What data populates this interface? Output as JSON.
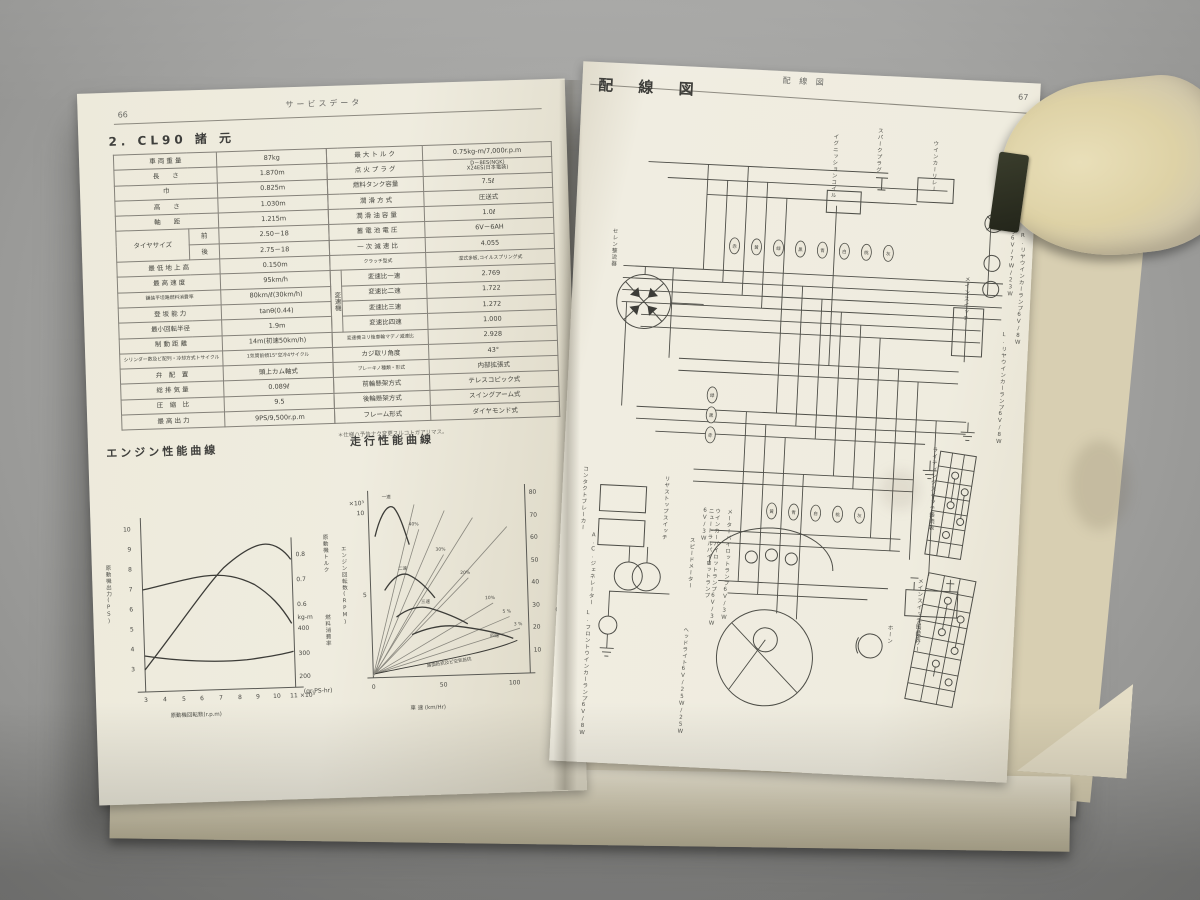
{
  "photo": {
    "background_color": "#a2a2a0",
    "page_color": "#efecdf",
    "object_description": "beige-block-on-page"
  },
  "left_page": {
    "page_number": "66",
    "header": "サービスデータ",
    "section_title": "2. CL90 諸 元",
    "tire": {
      "label": "タイヤサイズ",
      "front_key": "前",
      "front": "2.50－18",
      "rear_key": "後",
      "rear": "2.75－18"
    },
    "gear_group": "変速機",
    "spec_left": [
      {
        "label": "車 両 重 量",
        "value": "87kg"
      },
      {
        "label": "長　　さ",
        "value": "1.870m"
      },
      {
        "label": "巾",
        "value": "0.825m"
      },
      {
        "label": "高　　さ",
        "value": "1.030m"
      },
      {
        "label": "軸　　距",
        "value": "1.215m"
      },
      {
        "label": "最 低 地 上 高",
        "value": "0.150m"
      },
      {
        "label": "最 高 速 度",
        "value": "95km/h"
      },
      {
        "label": "舗装平坦路燃料消費率",
        "value": "80km/ℓ(30km/h)"
      },
      {
        "label": "登 坂 能 力",
        "value": "tanθ(0.44)"
      },
      {
        "label": "最小回転半径",
        "value": "1.9m"
      },
      {
        "label": "制 動 距 離",
        "value": "14m(初速50km/h)"
      },
      {
        "label": "シリンダー数及ビ配列・冷却方式トサイクル",
        "value": "1気筒前傾15°空冷4サイクル"
      },
      {
        "label": "弁　配　置",
        "value": "頭上カム軸式"
      },
      {
        "label": "総 排 気 量",
        "value": "0.089ℓ"
      },
      {
        "label": "圧　縮　比",
        "value": "9.5"
      },
      {
        "label": "最 高 出 力",
        "value": "9PS/9,500r.p.m"
      }
    ],
    "spec_right": [
      {
        "label": "最 大 ト ル ク",
        "value": "0.75kg-m/7,000r.p.m"
      },
      {
        "label": "点 火 プ ラ グ",
        "value": "D－8ES(NGK)\nX24ES(日本電装)"
      },
      {
        "label": "燃料タンク容量",
        "value": "7.5ℓ"
      },
      {
        "label": "潤 滑 方 式",
        "value": "圧送式"
      },
      {
        "label": "潤 滑 油 容 量",
        "value": "1.0ℓ"
      },
      {
        "label": "蓄 電 池 電 圧",
        "value": "6V－6AH"
      },
      {
        "label": "一 次 減 速 比",
        "value": "4.055"
      },
      {
        "label": "クラッチ型式",
        "value": "湿式多板,コイルスプリング式"
      },
      {
        "label": "変速比一速",
        "value": "2.769"
      },
      {
        "label": "変速比二速",
        "value": "1.722"
      },
      {
        "label": "変速比三速",
        "value": "1.272"
      },
      {
        "label": "変速比四速",
        "value": "1.000"
      },
      {
        "label": "変速機ヨリ後車輪マデノ減速比",
        "value": "2.928"
      },
      {
        "label": "カジ取リ角度",
        "value": "43°"
      },
      {
        "label": "ブレーキノ種類・形式",
        "value": "内部拡張式"
      },
      {
        "label": "前輪懸架方式",
        "value": "テレスコピック式"
      },
      {
        "label": "後輪懸架方式",
        "value": "スイングアーム式"
      },
      {
        "label": "フレーム形式",
        "value": "ダイヤモンド式"
      }
    ],
    "footnote": "＊仕様ハ予告ナク変更スルコトガアリマス。"
  },
  "right_page": {
    "page_number": "67",
    "header": "配 線 図",
    "title": "配 線 図",
    "components": [
      "セレン整流器",
      "A.C.ジェネレーター",
      "コンタクトブレーカー",
      "リヤストップスイッチ",
      "メインスイッチ",
      "ウインカーリレー",
      "イグニッションコイル",
      "スパークプラグ",
      "テールストップランプ6V/7W/23W",
      "R.リヤウインカーランプ6V/8W",
      "L.リヤウインカーランプ6V/8W",
      "スピードメーター",
      "ニュートラルパイロットランプ6V/3W",
      "ウインカーパイロットランプ6V/3W",
      "メーターパイロットランプ6V/3W",
      "ヘッドライト6V/25W/25W",
      "L.フロントウインカーランプ6V/8W",
      "ホーン",
      "バッテリー",
      "ライティングスイッチ接続表",
      "メインスイッチ接続表"
    ],
    "wire_colors": [
      "赤",
      "黄",
      "緑",
      "黒",
      "青",
      "白",
      "桃",
      "灰"
    ]
  },
  "chart_data": [
    {
      "type": "line",
      "title": "エンジン性能曲線",
      "xlabel": "原動機回転数(r.p.m)",
      "x_unit": "×10³",
      "x": [
        3,
        4,
        5,
        6,
        7,
        8,
        9,
        10,
        11
      ],
      "ylabel_left": "原動機出力(PS)",
      "yticks_left": [
        10,
        9,
        8,
        7,
        6,
        5,
        4,
        3
      ],
      "ylabel_torque": "原動機トルク",
      "torque_unit": "kg-m",
      "yticks_torque": [
        0.8,
        0.7,
        0.6
      ],
      "ylabel_fuel": "燃料消費率",
      "fuel_unit": "(gr-PS-hr)",
      "yticks_fuel": [
        400,
        300,
        200
      ],
      "series": [
        {
          "name": "出力(PS)",
          "values": [
            2.9,
            4.1,
            5.3,
            6.5,
            7.5,
            8.4,
            8.9,
            9.0,
            8.2
          ]
        },
        {
          "name": "トルク(kg-m)",
          "values": [
            0.7,
            0.72,
            0.74,
            0.75,
            0.74,
            0.72,
            0.69,
            0.64,
            0.56
          ]
        },
        {
          "name": "燃料消費率(gr-PS-hr)",
          "values": [
            310,
            298,
            290,
            286,
            286,
            289,
            294,
            303,
            312
          ]
        }
      ]
    },
    {
      "type": "line",
      "title": "走行性能曲線",
      "xlabel": "車 速 (km/Hr)",
      "xticks": [
        0,
        50,
        100
      ],
      "xlim": [
        0,
        110
      ],
      "ylabel_left": "エンジン回転数(RPM)",
      "left_unit": "×10³",
      "yticks_left": [
        10,
        5
      ],
      "ylabel_right": "駆動力",
      "right_unit": "(kg)",
      "yticks_right": [
        80,
        70,
        60,
        50,
        40,
        30,
        20,
        10
      ],
      "gears": [
        {
          "name": "一速",
          "speed": [
            5,
            15,
            28
          ],
          "force": [
            62,
            75,
            58
          ]
        },
        {
          "name": "二速",
          "speed": [
            10,
            25,
            45
          ],
          "force": [
            38,
            45,
            34
          ]
        },
        {
          "name": "三速",
          "speed": [
            18,
            40,
            68
          ],
          "force": [
            26,
            30,
            22
          ]
        },
        {
          "name": "四速",
          "speed": [
            28,
            60,
            100
          ],
          "force": [
            18,
            21,
            15
          ]
        }
      ],
      "grade_lines": [
        "40%",
        "30%",
        "20%",
        "10%",
        "5 %",
        "3 %"
      ],
      "resistance_label": "路面抵抗及ビ空気抵抗"
    }
  ]
}
